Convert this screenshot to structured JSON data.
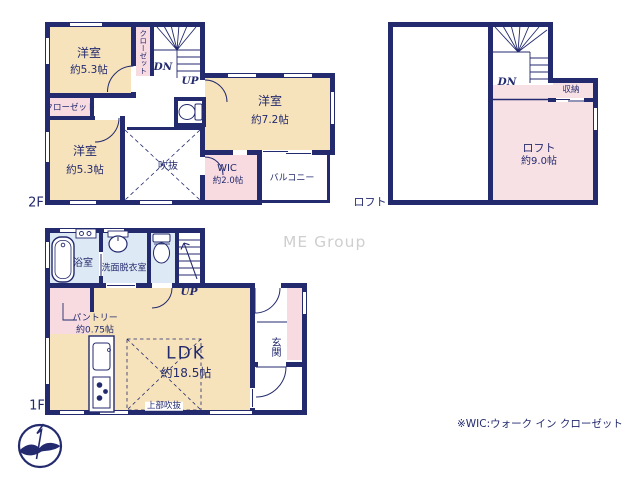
{
  "watermark": "ME Group",
  "footnote": "※WIC:ウォーク イン クローゼット",
  "colors": {
    "wall": "#232a6e",
    "room": "#f6e3bb",
    "closet": "#f7dbe0",
    "loft": "#f8e1e4",
    "bath": "#dde9f4",
    "watermark": "#cfcfcf"
  },
  "floor2": {
    "floor_label": "2F",
    "bedroom_top": {
      "name": "洋室",
      "size": "約5.3帖"
    },
    "closet_vertical": "クローゼット",
    "closet_horizontal": "クローゼット",
    "stairs_down": "DN",
    "stairs_up": "UP",
    "bedroom_right": {
      "name": "洋室",
      "size": "約7.2帖"
    },
    "bedroom_bottom": {
      "name": "洋室",
      "size": "約5.3帖"
    },
    "void": "吹抜",
    "wic": {
      "name": "WIC",
      "size": "約2.0帖"
    },
    "balcony": "バルコニー"
  },
  "loft": {
    "floor_label": "ロフト",
    "stairs_down": "DN",
    "storage": "収納",
    "room": {
      "name": "ロフト",
      "size": "約9.0帖"
    }
  },
  "floor1": {
    "floor_label": "1F",
    "bathroom": "浴室",
    "washroom": "洗面脱衣室",
    "stairs_up": "UP",
    "pantry": {
      "name": "パントリー",
      "size": "約0.75帖"
    },
    "ldk": {
      "name": "LDK",
      "size": "約18.5帖"
    },
    "upper_void": "上部吹抜",
    "entrance": "玄関"
  }
}
